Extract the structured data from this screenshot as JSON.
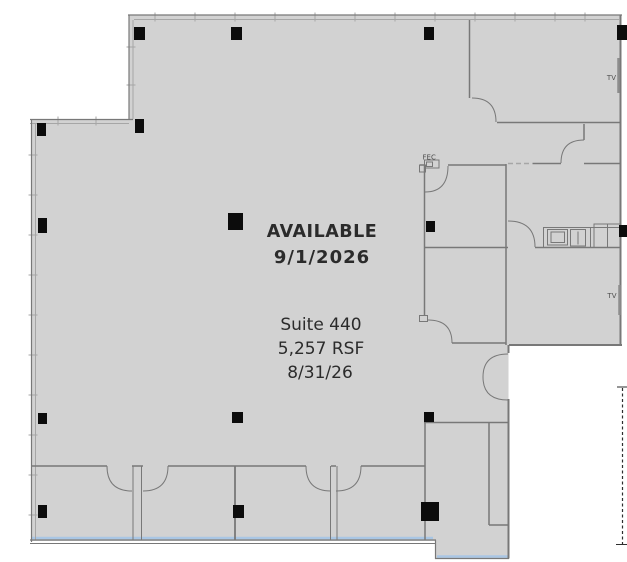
{
  "plan": {
    "availability": {
      "status": "AVAILABLE",
      "date": "9/1/2026"
    },
    "suite": {
      "name": "Suite 440",
      "area": "5,257 RSF",
      "date": "8/31/26"
    },
    "annotations": {
      "fec": "FEC",
      "tv_upper": "TV",
      "tv_lower": "TV"
    }
  },
  "colors": {
    "background": "#ffffff",
    "floor_fill": "#d2d2d2",
    "wall": "#787878",
    "wall_light": "#a6a6a6",
    "column": "#0c0c0c",
    "text_primary": "#2b2b2b",
    "text_secondary": "#4f4f4f",
    "edge_highlight": "#a9c6e4",
    "match_line": "#2e2e2e",
    "fixture": "#8d8d8d"
  }
}
